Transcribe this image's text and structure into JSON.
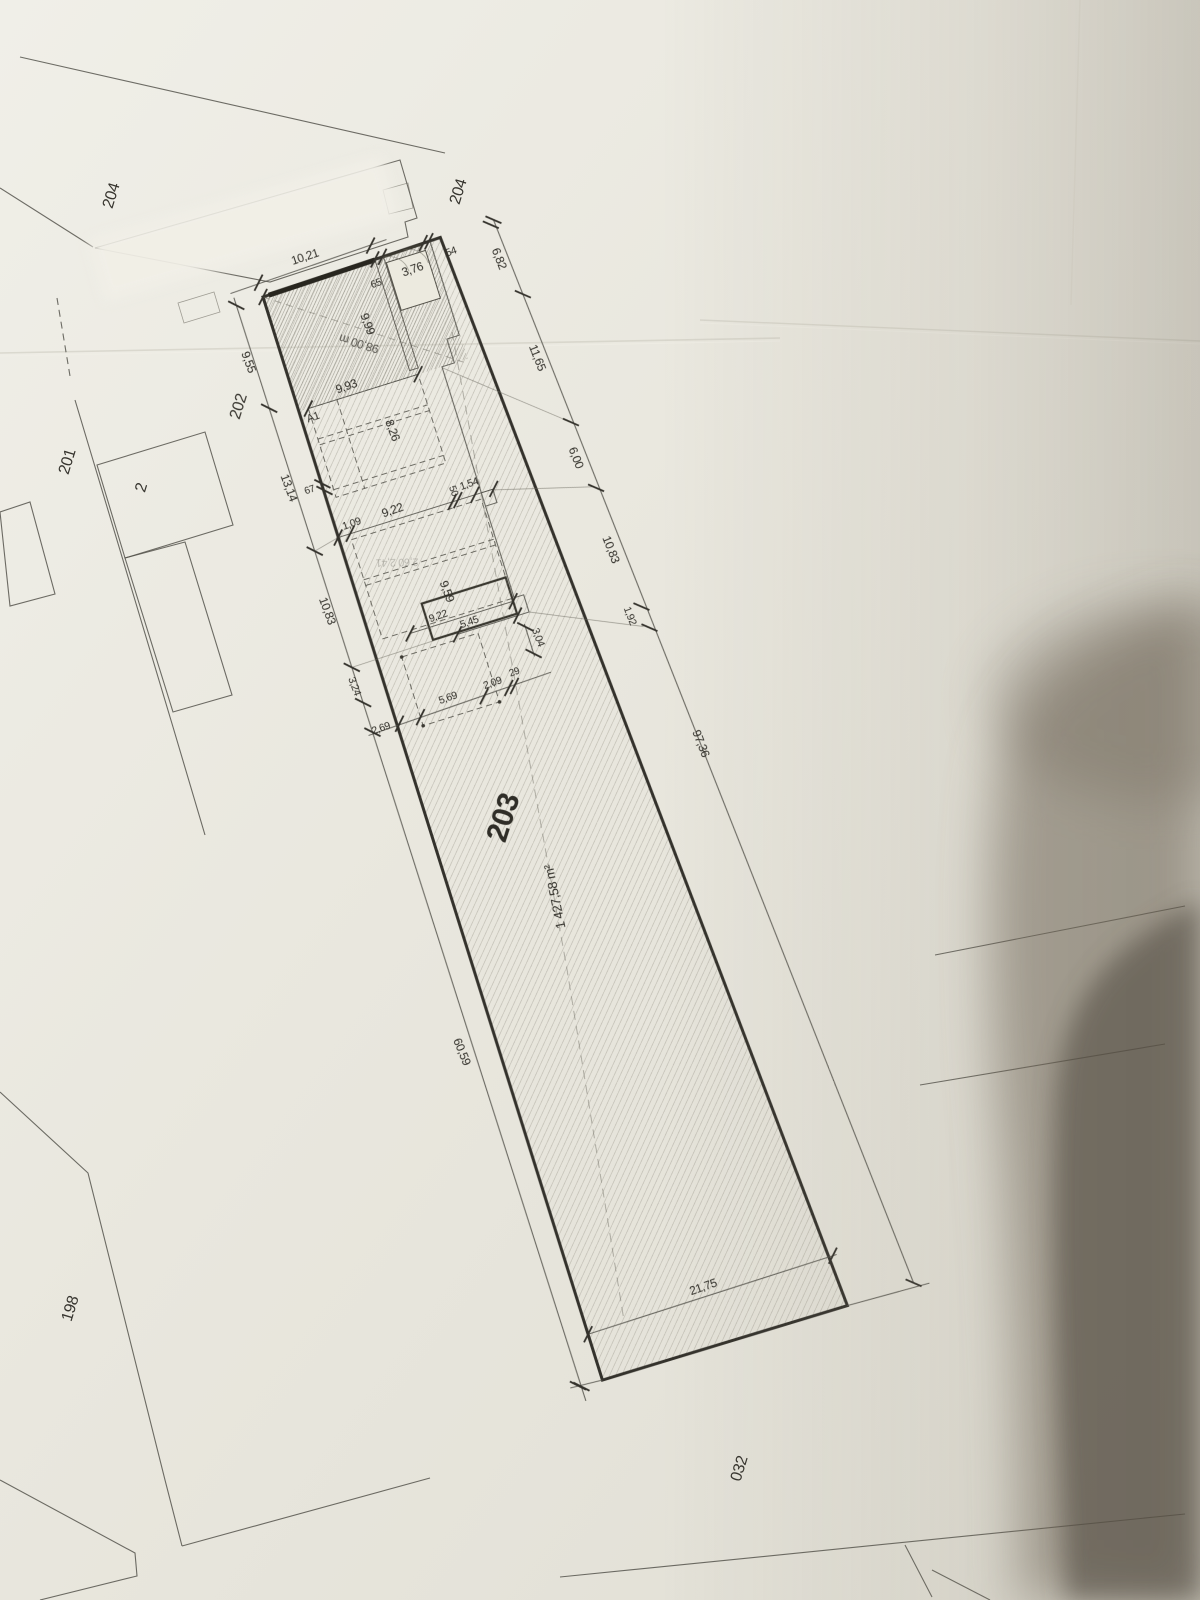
{
  "document_type": "cadastral site plan photograph",
  "parcels": {
    "main": {
      "number": "203",
      "area": "1 427,58 m²"
    },
    "street_left": "204",
    "street_right": "204",
    "neighbor_202": "202",
    "neighbor_201": "201",
    "house": "2",
    "neighbor_198": "198",
    "bottom": "032"
  },
  "building": {
    "label": "A1",
    "diagonal_note": "98,00 m",
    "ghost": "2,60 2,41"
  },
  "dimensions": {
    "top_edge": [
      "10,21",
      "65",
      "3,76",
      "54"
    ],
    "left_chain": [
      "9,55",
      "13,14",
      "10,83",
      "3,24",
      "2,69",
      "60,59"
    ],
    "right_chain": [
      "6,82",
      "11,65",
      "6,00",
      "10,83",
      "1,92"
    ],
    "right_total": "97,36",
    "building_depths": [
      "9,99",
      "8,26",
      "9,59",
      "3,04"
    ],
    "room_widths": [
      "9,93",
      "1,09",
      "9,22",
      "50",
      "1,54",
      "67",
      "9,22",
      "5,45"
    ],
    "lower_chain": [
      "2,09",
      "29",
      "5,69"
    ],
    "bottom_width": "21,75"
  },
  "colors": {
    "paper": "#e9e7de",
    "ink": "#2f2d27",
    "boundary": "#34322c",
    "shadow": "#57503f"
  }
}
